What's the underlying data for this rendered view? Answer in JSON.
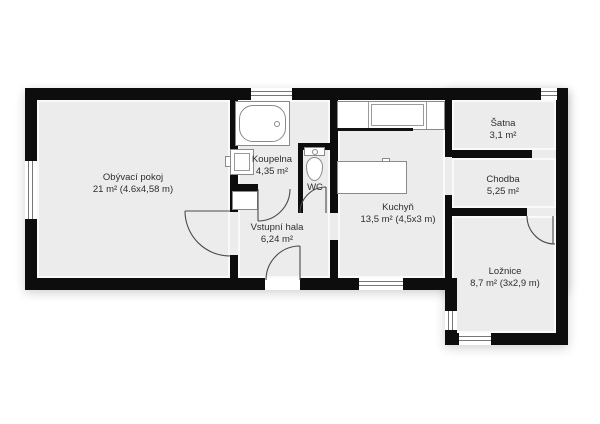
{
  "floorplan": {
    "rooms": {
      "obyvaci_pokoj": {
        "name": "Obývací pokoj",
        "area": "21 m² (4.6x4,58 m)"
      },
      "koupelna": {
        "name": "Koupelna",
        "area": "4,35 m²"
      },
      "wc": {
        "name": "WC"
      },
      "vstupni_hala": {
        "name": "Vstupní hala",
        "area": "6,24 m²"
      },
      "kuchyn": {
        "name": "Kuchyň",
        "area": "13,5 m² (4,5x3 m)"
      },
      "satna": {
        "name": "Šatna",
        "area": "3,1 m²"
      },
      "chodba": {
        "name": "Chodba",
        "area": "5,25 m²"
      },
      "loznice": {
        "name": "Ložnice",
        "area": "8,7 m² (3x2,9 m)"
      }
    },
    "colors": {
      "wall": "#0d0d0d",
      "floor": "#ececec",
      "background": "#ffffff"
    }
  }
}
